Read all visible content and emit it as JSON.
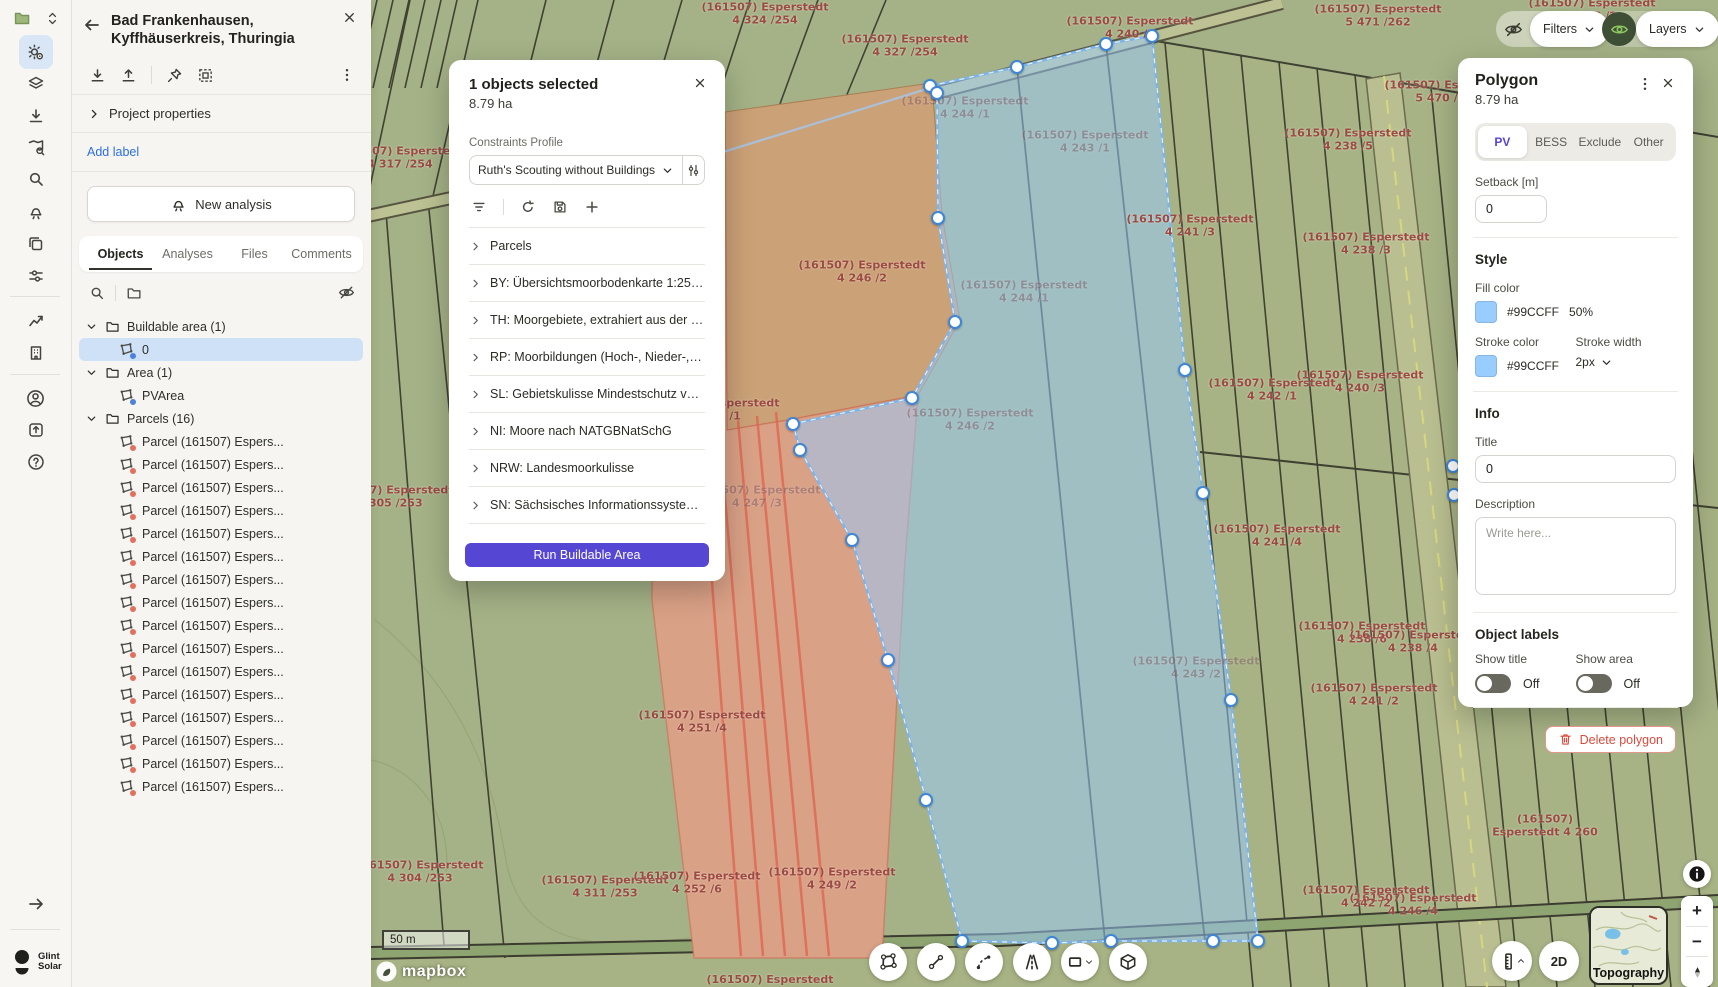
{
  "project_panel": {
    "title_line1": "Bad Frankenhausen,",
    "title_line2": "Kyffhäuserkreis, Thuringia",
    "project_properties": "Project properties",
    "add_label": "Add label",
    "new_analysis": "New analysis",
    "tabs": [
      "Objects",
      "Analyses",
      "Files",
      "Comments"
    ],
    "active_tab": "Objects",
    "tree": {
      "buildable_folder": "Buildable area (1)",
      "buildable_item": "0",
      "area_folder": "Area (1)",
      "area_item": "PVArea",
      "parcels": {
        "folder": "Parcels (16)",
        "count": 16,
        "item_label": "Parcel (161507) Espers..."
      }
    }
  },
  "selection_dialog": {
    "title": "1 objects selected",
    "area": "8.79 ha",
    "constraints_label": "Constraints Profile",
    "profile_value": "Ruth's Scouting without Buildings",
    "layers": [
      "Parcels",
      "BY: Übersichtsmoorbodenkarte 1:25.000",
      "TH: Moorgebiete, extrahiert aus der Bo...",
      "RP: Moorbildungen (Hoch-, Nieder-, Üb...",
      "SL: Gebietskulisse Mindestschutz von F...",
      "NI: Moore nach NATGBNatSchG",
      "NRW: Landesmoorkulisse",
      "SN: Sächsisches Informationssystem für..."
    ],
    "run_button": "Run Buildable Area"
  },
  "polygon_panel": {
    "title": "Polygon",
    "area": "8.79 ha",
    "tabs": [
      "PV",
      "BESS",
      "Exclude",
      "Other"
    ],
    "active_tab": "PV",
    "setback_label": "Setback [m]",
    "setback_value": "0",
    "style": {
      "heading": "Style",
      "fill_label": "Fill color",
      "fill_hex": "#99CCFF",
      "fill_opacity": "50%",
      "stroke_label": "Stroke color",
      "stroke_hex": "#99CCFF",
      "stroke_width_label": "Stroke width",
      "stroke_width": "2px"
    },
    "info": {
      "heading": "Info",
      "title_label": "Title",
      "title_value": "0",
      "description_label": "Description",
      "description_placeholder": "Write here..."
    },
    "object_labels": {
      "heading": "Object labels",
      "show_title": "Show title",
      "show_area": "Show area",
      "title_state": "Off",
      "area_state": "Off"
    },
    "delete_button": "Delete polygon"
  },
  "top_controls": {
    "filters": "Filters",
    "layers": "Layers"
  },
  "bottom_controls": {
    "twod": "2D",
    "topography": "Topography"
  },
  "branding": {
    "logo_line1": "Glint",
    "logo_line2": "Solar",
    "attribution": "mapbox"
  },
  "map": {
    "scale_text": "50 m",
    "accent_fill": "#99CCFF",
    "labels": [
      {
        "x": 765,
        "y": 14,
        "t1": "(161507) Esperstedt",
        "t2": "4 324 /254"
      },
      {
        "x": 905,
        "y": 46,
        "t1": "(161507) Esperstedt",
        "t2": "4 327 /254"
      },
      {
        "x": 400,
        "y": 158,
        "t1": "(161507) Esperstedt",
        "t2": "4 317 /254"
      },
      {
        "x": 1130,
        "y": 28,
        "t1": "(161507) Esperstedt",
        "t2": "4 240 /4"
      },
      {
        "x": 1378,
        "y": 16,
        "t1": "(161507) Esperstedt",
        "t2": "5 471 /262"
      },
      {
        "x": 1592,
        "y": 10,
        "t1": "(161507) Esperstedt",
        "t2": "4 238 /2"
      },
      {
        "x": 1448,
        "y": 92,
        "t1": "(161507) Esperstedt",
        "t2": "5 470 /262"
      },
      {
        "x": 1190,
        "y": 226,
        "t1": "(161507) Esperstedt",
        "t2": "4 241 /3"
      },
      {
        "x": 1348,
        "y": 140,
        "t1": "(161507) Esperstedt",
        "t2": "4 238 /5"
      },
      {
        "x": 1366,
        "y": 244,
        "t1": "(161507) Esperstedt",
        "t2": "4 238 /3"
      },
      {
        "x": 1545,
        "y": 162,
        "t1": "(161507) Esperstedt",
        "t2": "5 468 /2"
      },
      {
        "x": 965,
        "y": 108,
        "t1": "(161507) Esperstedt",
        "t2": "4 244 /1",
        "f": 1
      },
      {
        "x": 1085,
        "y": 142,
        "t1": "(161507) Esperstedt",
        "t2": "4 243 /1",
        "f": 1
      },
      {
        "x": 1024,
        "y": 292,
        "t1": "(161507) Esperstedt",
        "t2": "4 244 /1",
        "f": 1
      },
      {
        "x": 862,
        "y": 272,
        "t1": "(161507) Esperstedt",
        "t2": "4 246 /2"
      },
      {
        "x": 716,
        "y": 410,
        "t1": "(161507) Esperstedt",
        "t2": "4 249 /1"
      },
      {
        "x": 757,
        "y": 497,
        "t1": "(161507) Esperstedt",
        "t2": "4 247 /3",
        "f": 1
      },
      {
        "x": 970,
        "y": 420,
        "t1": "(161507) Esperstedt",
        "t2": "4 246 /2",
        "f": 1
      },
      {
        "x": 1272,
        "y": 390,
        "t1": "(161507) Esperstedt",
        "t2": "4 242 /1"
      },
      {
        "x": 1360,
        "y": 382,
        "t1": "(161507) Esperstedt",
        "t2": "4 240 /3"
      },
      {
        "x": 1277,
        "y": 536,
        "t1": "(161507) Esperstedt",
        "t2": "4 241 /4"
      },
      {
        "x": 1196,
        "y": 668,
        "t1": "(161507) Esperstedt",
        "t2": "4 243 /2",
        "f": 1
      },
      {
        "x": 1362,
        "y": 633,
        "t1": "(161507) Esperstedt",
        "t2": "4 238 /6"
      },
      {
        "x": 1413,
        "y": 642,
        "t1": "(161507) Esperstedt",
        "t2": "4 238 /4"
      },
      {
        "x": 1374,
        "y": 695,
        "t1": "(161507) Esperstedt",
        "t2": "4 241 /2"
      },
      {
        "x": 702,
        "y": 722,
        "t1": "(161507) Esperstedt",
        "t2": "4 251 /4"
      },
      {
        "x": 390,
        "y": 497,
        "t1": "(161507) Esperstedt",
        "t2": "4 305 /253"
      },
      {
        "x": 420,
        "y": 872,
        "t1": "(161507) Esperstedt",
        "t2": "4 304 /253"
      },
      {
        "x": 605,
        "y": 887,
        "t1": "(161507) Esperstedt",
        "t2": "4 311 /253"
      },
      {
        "x": 697,
        "y": 883,
        "t1": "(161507) Esperstedt",
        "t2": "4 252 /6"
      },
      {
        "x": 832,
        "y": 879,
        "t1": "(161507) Esperstedt",
        "t2": "4 249 /2"
      },
      {
        "x": 1545,
        "y": 826,
        "t1": "(161507)",
        "t2": "Esperstedt 4 260"
      },
      {
        "x": 1413,
        "y": 905,
        "t1": "(161507) Esperstedt",
        "t2": "4 246 /4"
      },
      {
        "x": 1366,
        "y": 897,
        "t1": "(161507) Esperstedt",
        "t2": "4 242 /2"
      },
      {
        "x": 770,
        "y": 980,
        "t1": "(161507) Esperstedt",
        "t2": ""
      }
    ],
    "vertices": [
      [
        930,
        86
      ],
      [
        1017,
        67
      ],
      [
        1106,
        44
      ],
      [
        1152,
        36
      ],
      [
        1185,
        370
      ],
      [
        1203,
        493
      ],
      [
        1231,
        700
      ],
      [
        1258,
        941
      ],
      [
        1213,
        941
      ],
      [
        1111,
        941
      ],
      [
        1052,
        943
      ],
      [
        962,
        941
      ],
      [
        926,
        800
      ],
      [
        888,
        660
      ],
      [
        852,
        540
      ],
      [
        800,
        450
      ],
      [
        793,
        424
      ],
      [
        912,
        398
      ],
      [
        955,
        322
      ],
      [
        938,
        218
      ],
      [
        937,
        93
      ],
      [
        1453,
        466
      ],
      [
        1454,
        495
      ]
    ]
  }
}
